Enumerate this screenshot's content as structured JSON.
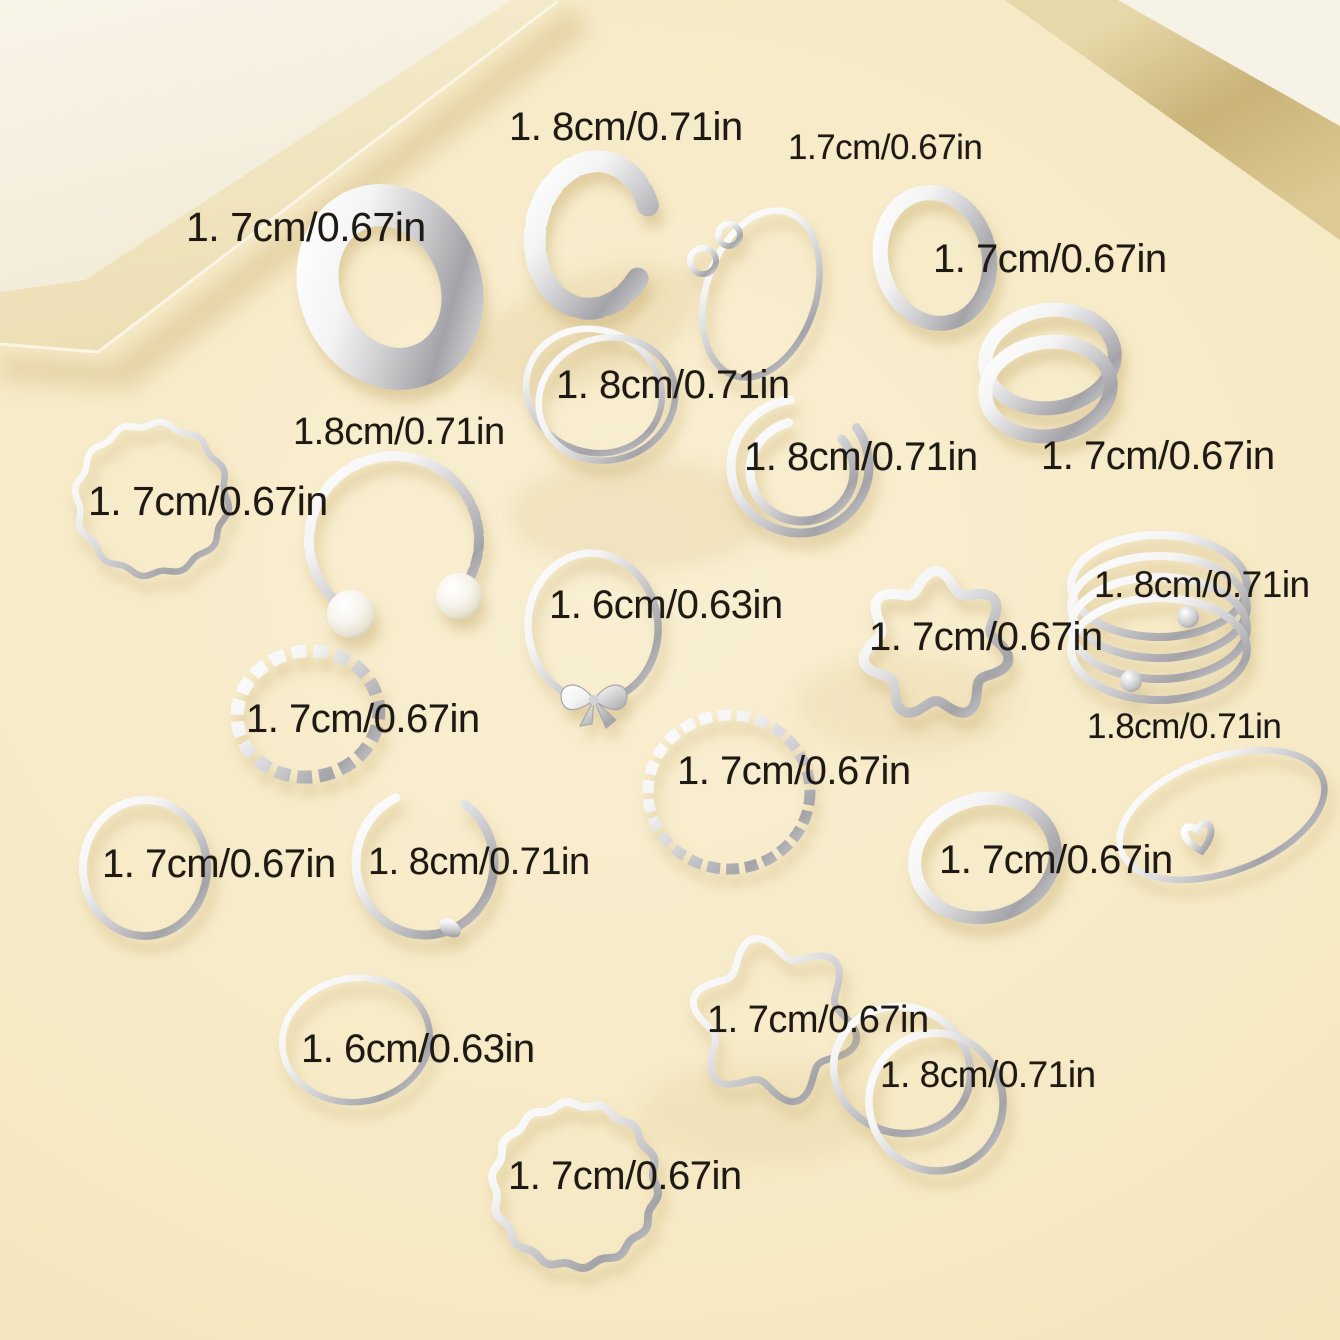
{
  "scene": {
    "description": "Product photo of a silver knuckle ring set on a cream backdrop with a white display platform",
    "ring_count": 22,
    "background_color": "#f6e9c4",
    "platform_color": "#f8f3e6",
    "prop_band_color": "#c9b379",
    "label_text_color": "#1e1a13",
    "silver_color": "#cfcfd2"
  },
  "rings": [
    {
      "name": "chain-link-cuff-ring",
      "size_label": "1. 8cm/0.71in"
    },
    {
      "name": "infinity-ring",
      "size_label": "1.7cm/0.67in"
    },
    {
      "name": "wide-plain-band-ring",
      "size_label": "1. 7cm/0.67in"
    },
    {
      "name": "plain-band-ring",
      "size_label": "1. 7cm/0.67in"
    },
    {
      "name": "criss-cross-ring",
      "size_label": "1. 8cm/0.71in"
    },
    {
      "name": "double-line-cuff-ring",
      "size_label": "1. 8cm/0.71in"
    },
    {
      "name": "double-wrap-ring",
      "size_label": "1. 7cm/0.67in"
    },
    {
      "name": "pearl-twist-cuff-ring",
      "size_label": "1.8cm/0.71in"
    },
    {
      "name": "thin-wavy-ring",
      "size_label": "1. 7cm/0.67in"
    },
    {
      "name": "bow-ring",
      "size_label": "1. 6cm/0.63in"
    },
    {
      "name": "hollow-hearts-ring",
      "size_label": "1. 7cm/0.67in"
    },
    {
      "name": "spiral-coil-ring",
      "size_label": "1. 8cm/0.71in"
    },
    {
      "name": "chain-texture-ring",
      "size_label": "1. 7cm/0.67in"
    },
    {
      "name": "twisted-rope-ring",
      "size_label": "1. 7cm/0.67in"
    },
    {
      "name": "heart-accent-ring",
      "size_label": "1.8cm/0.71in"
    },
    {
      "name": "thin-plain-ring",
      "size_label": "1. 7cm/0.67in"
    },
    {
      "name": "knot-cuff-ring",
      "size_label": "1. 8cm/0.71in"
    },
    {
      "name": "plain-band-ring-2",
      "size_label": "1. 7cm/0.67in"
    },
    {
      "name": "thin-plain-ring-2",
      "size_label": "1. 6cm/0.63in"
    },
    {
      "name": "zigzag-wavy-ring",
      "size_label": "1. 7cm/0.67in"
    },
    {
      "name": "criss-cross-double-ring",
      "size_label": "1. 8cm/0.71in"
    },
    {
      "name": "hammered-thin-ring",
      "size_label": "1. 7cm/0.67in"
    }
  ]
}
